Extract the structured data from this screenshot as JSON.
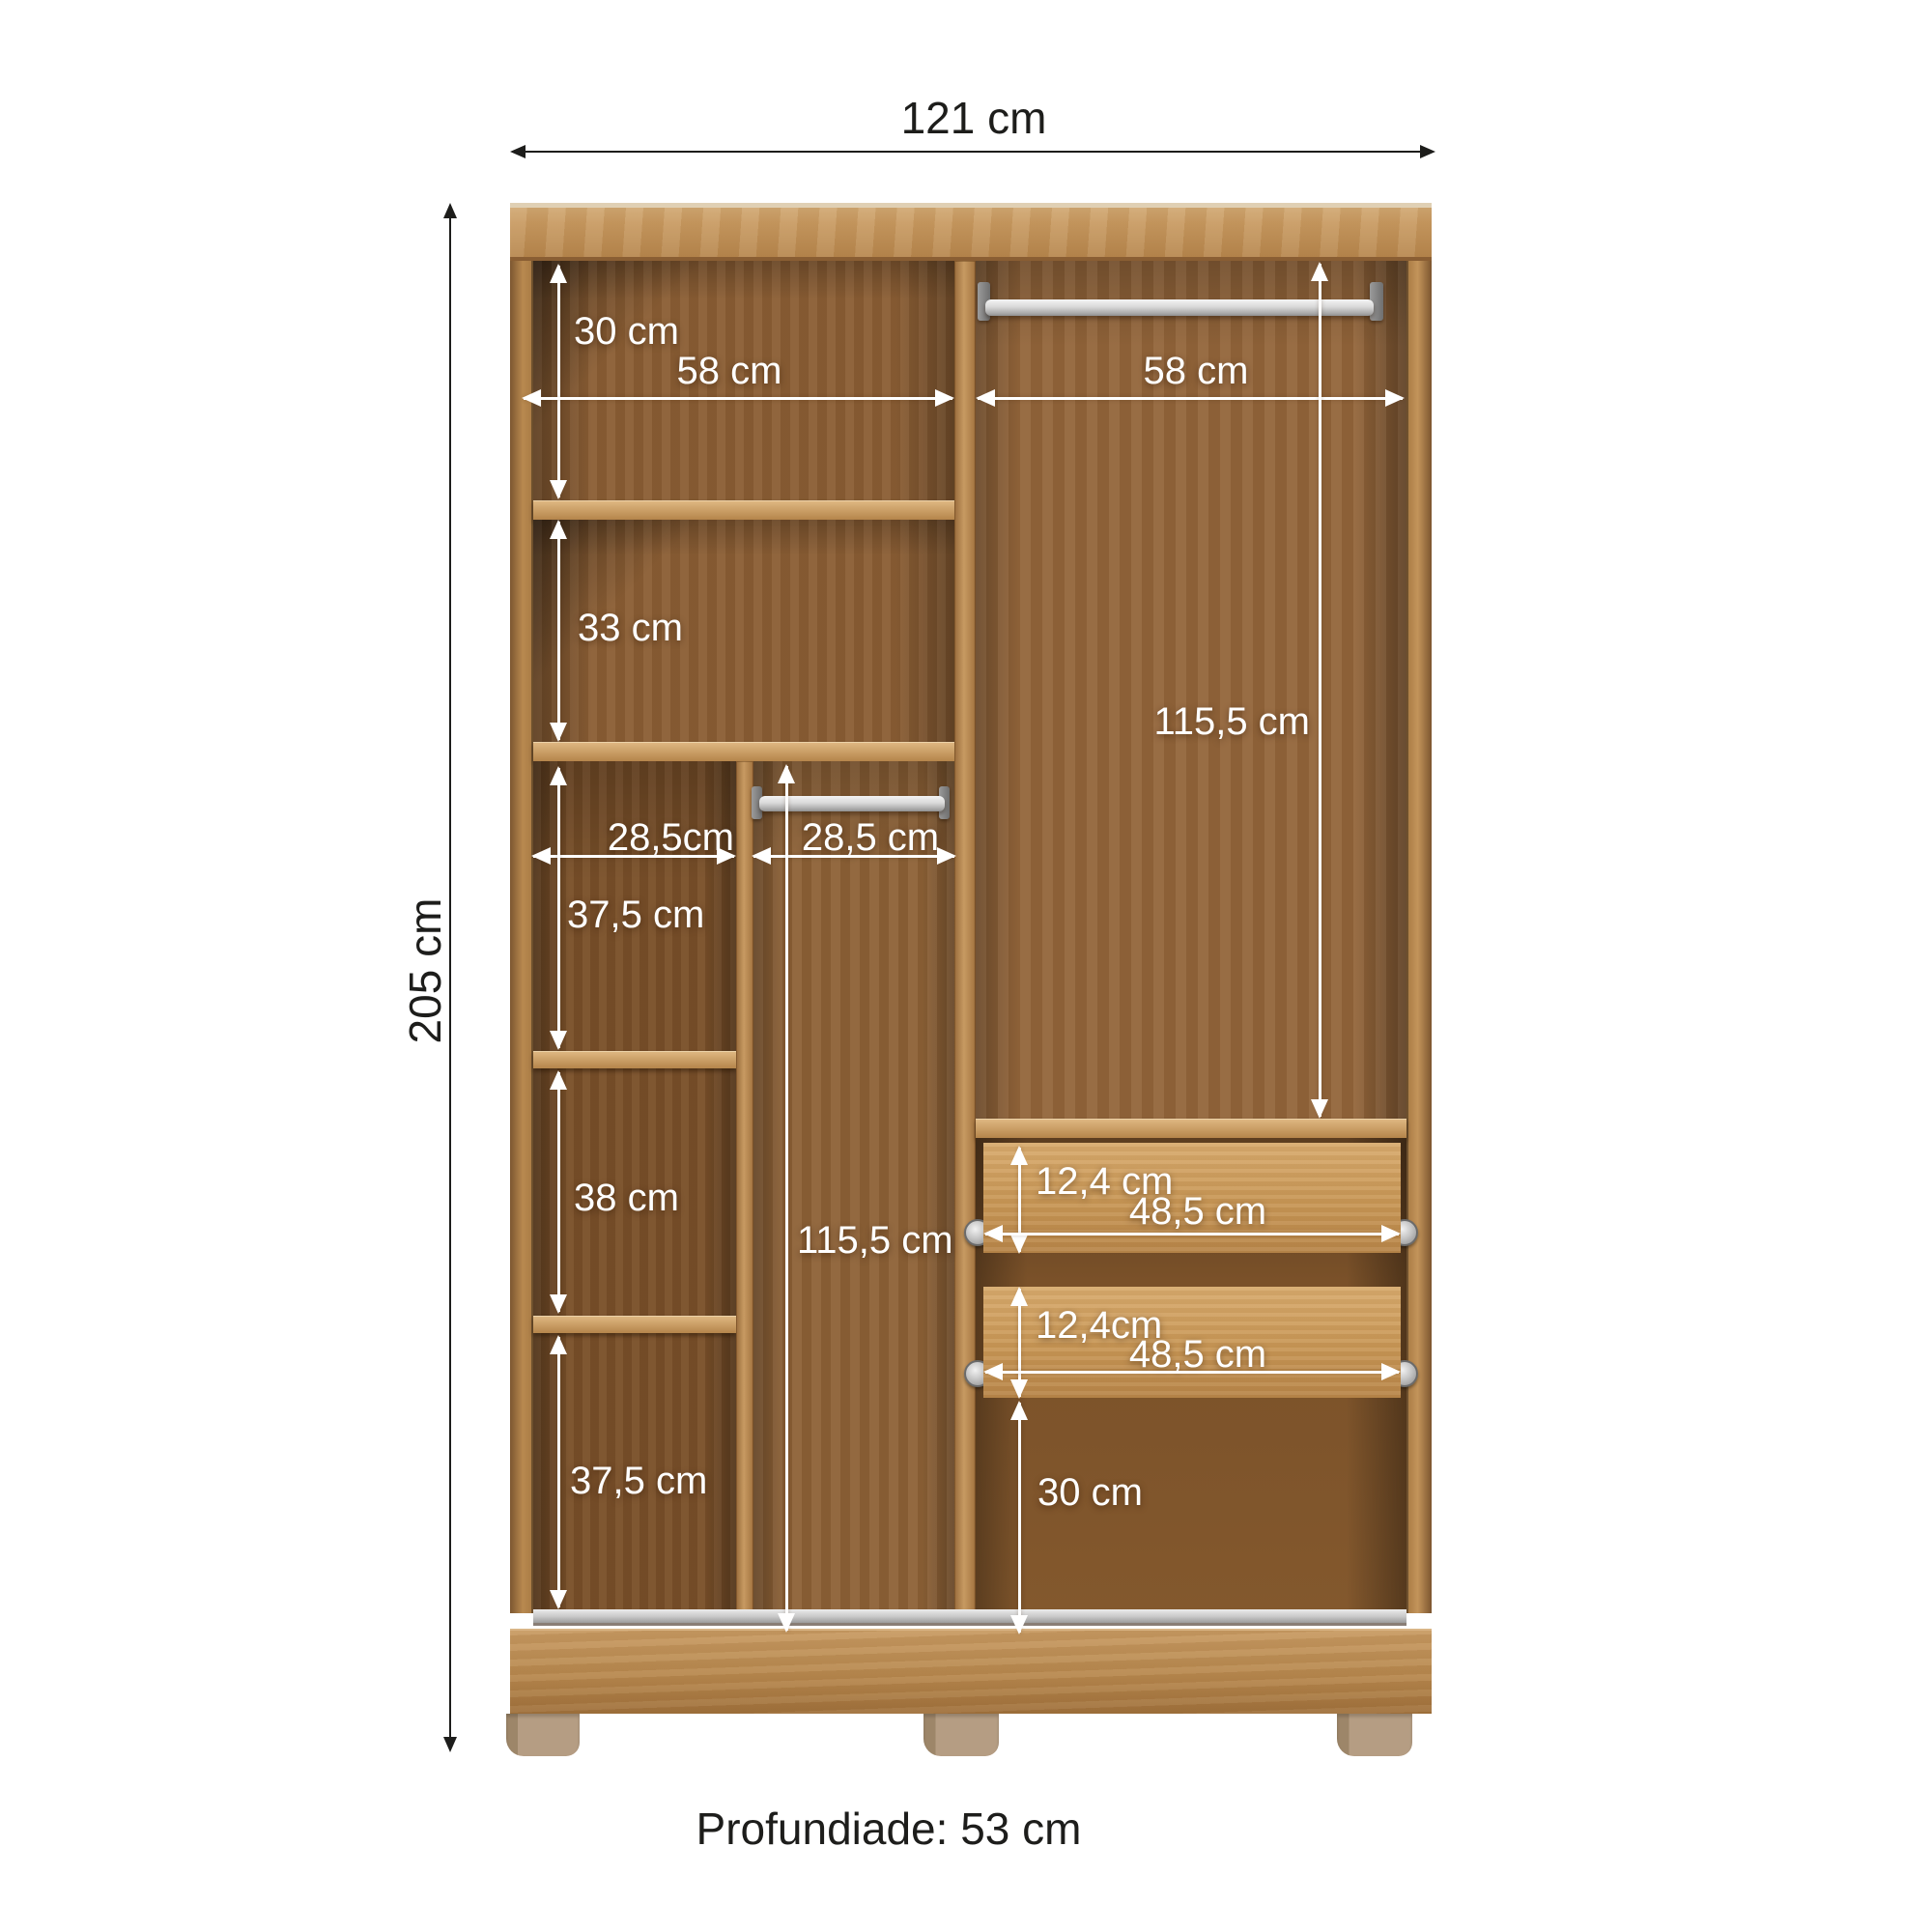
{
  "diagram": {
    "overall_width": "121 cm",
    "overall_height": "205 cm",
    "depth_note": "Profundiade: 53 cm",
    "dims": {
      "top_left_comp_height": "30 cm",
      "left_half_width": "58 cm",
      "right_half_width": "58 cm",
      "second_comp_height": "33 cm",
      "left_col_width": "28,5cm",
      "mid_col_width": "28,5 cm",
      "left_col_comp1_height": "37,5 cm",
      "left_col_comp2_height": "38 cm",
      "left_col_comp3_height": "37,5 cm",
      "mid_hang_height": "115,5 cm",
      "right_hang_height": "115,5 cm",
      "drawer1_height": "12,4 cm",
      "drawer1_width": "48,5 cm",
      "drawer2_height": "12,4cm",
      "drawer2_width": "48,5 cm",
      "bottom_space_height": "30 cm"
    },
    "colors": {
      "wood_front": "#c89a61",
      "wood_interior": "#8b5e34",
      "rod_silver": "#d9d9d9",
      "feet": "#b59d83",
      "dim_interior": "#ffffff",
      "dim_exterior": "#1d1d1b"
    }
  }
}
